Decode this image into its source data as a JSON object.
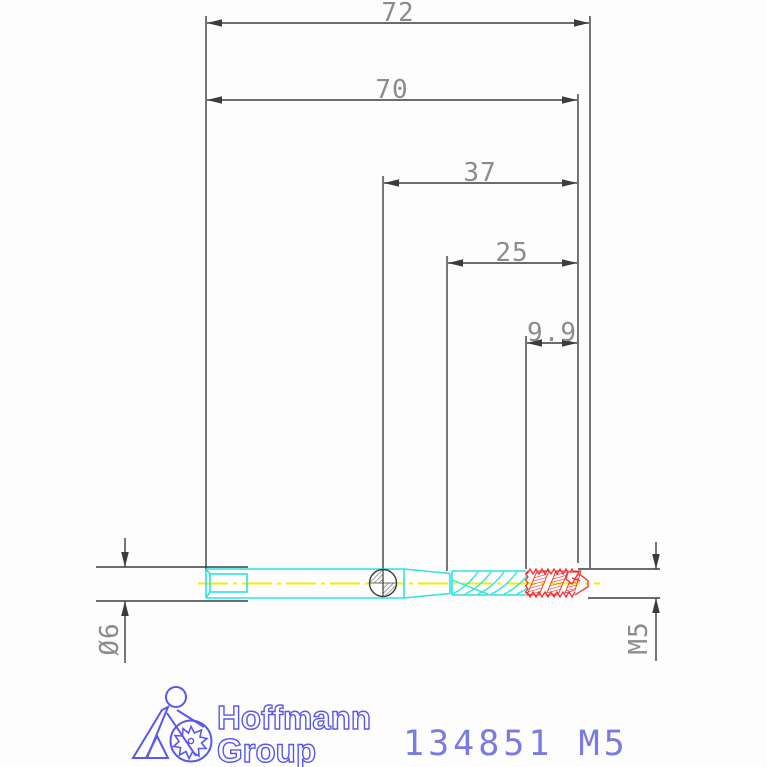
{
  "drawing": {
    "title_implied": "tap tool technical drawing",
    "dimensions": [
      {
        "label": "72"
      },
      {
        "label": "70"
      },
      {
        "label": "37"
      },
      {
        "label": "25"
      },
      {
        "label": "9.9"
      }
    ],
    "diameter_label": "Ø6",
    "thread_label": "M5",
    "colors": {
      "outline_cyan": "#2ae4e4",
      "thread_red": "#f23030",
      "centerline_yellow": "#f6ed00",
      "dimension_line_gray": "#3c3c3c",
      "dimension_text_gray": "#8c8c8c",
      "logo_blue": "#5858ee",
      "part_number_blue": "#7a7ae0"
    }
  },
  "footer": {
    "logo_line1": "Hoffmann",
    "logo_line2": "Group",
    "part_number": "134851 M5"
  }
}
